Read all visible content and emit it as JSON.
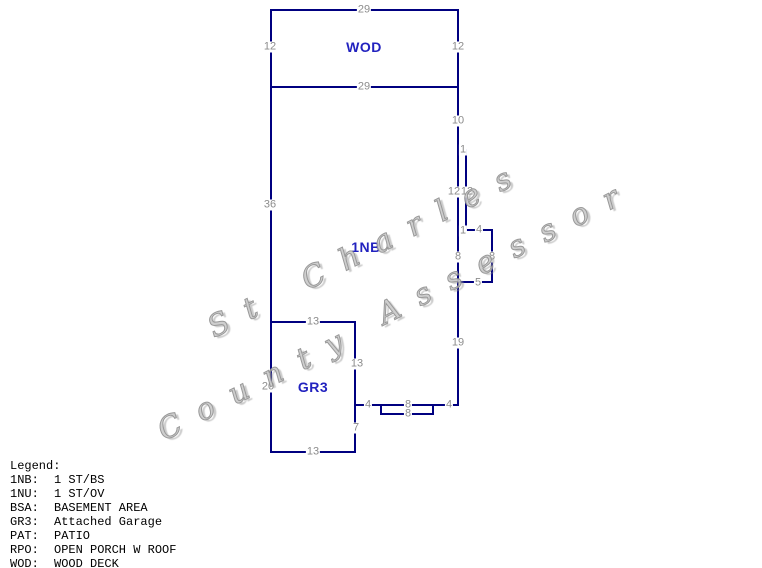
{
  "colors": {
    "line": "#000080",
    "dim_label": "#8c8c8c",
    "area_label": "#2222bf",
    "legend_text": "#000000",
    "watermark": "#9a9a9a",
    "background": "#ffffff"
  },
  "diagram": {
    "lines": [
      {
        "x1": 271,
        "y1": 10,
        "x2": 458,
        "y2": 10
      },
      {
        "x1": 271,
        "y1": 10,
        "x2": 271,
        "y2": 87
      },
      {
        "x1": 458,
        "y1": 10,
        "x2": 458,
        "y2": 87
      },
      {
        "x1": 271,
        "y1": 87,
        "x2": 458,
        "y2": 87
      },
      {
        "x1": 271,
        "y1": 87,
        "x2": 271,
        "y2": 322
      },
      {
        "x1": 271,
        "y1": 322,
        "x2": 271,
        "y2": 452
      },
      {
        "x1": 271,
        "y1": 322,
        "x2": 355,
        "y2": 322
      },
      {
        "x1": 355,
        "y1": 322,
        "x2": 355,
        "y2": 452
      },
      {
        "x1": 271,
        "y1": 452,
        "x2": 355,
        "y2": 452
      },
      {
        "x1": 458,
        "y1": 87,
        "x2": 458,
        "y2": 230
      },
      {
        "x1": 458,
        "y1": 150,
        "x2": 466,
        "y2": 150
      },
      {
        "x1": 466,
        "y1": 150,
        "x2": 466,
        "y2": 230
      },
      {
        "x1": 458,
        "y1": 230,
        "x2": 492,
        "y2": 230
      },
      {
        "x1": 492,
        "y1": 230,
        "x2": 492,
        "y2": 282
      },
      {
        "x1": 458,
        "y1": 230,
        "x2": 458,
        "y2": 282
      },
      {
        "x1": 458,
        "y1": 282,
        "x2": 492,
        "y2": 282
      },
      {
        "x1": 458,
        "y1": 282,
        "x2": 458,
        "y2": 405
      },
      {
        "x1": 355,
        "y1": 405,
        "x2": 458,
        "y2": 405
      },
      {
        "x1": 381,
        "y1": 405,
        "x2": 381,
        "y2": 414
      },
      {
        "x1": 433,
        "y1": 405,
        "x2": 433,
        "y2": 414
      },
      {
        "x1": 381,
        "y1": 414,
        "x2": 433,
        "y2": 414
      }
    ],
    "dim_labels": [
      {
        "text": "29",
        "x": 364,
        "y": 10
      },
      {
        "text": "12",
        "x": 270,
        "y": 47
      },
      {
        "text": "12",
        "x": 458,
        "y": 47
      },
      {
        "text": "29",
        "x": 364,
        "y": 87
      },
      {
        "text": "10",
        "x": 458,
        "y": 121
      },
      {
        "text": "1",
        "x": 463,
        "y": 150
      },
      {
        "text": "12",
        "x": 454,
        "y": 192
      },
      {
        "text": "12",
        "x": 467,
        "y": 192
      },
      {
        "text": "1",
        "x": 463,
        "y": 231
      },
      {
        "text": "4",
        "x": 479,
        "y": 230
      },
      {
        "text": "8",
        "x": 458,
        "y": 257
      },
      {
        "text": "8",
        "x": 492,
        "y": 257
      },
      {
        "text": "5",
        "x": 478,
        "y": 283
      },
      {
        "text": "19",
        "x": 458,
        "y": 343
      },
      {
        "text": "36",
        "x": 270,
        "y": 205
      },
      {
        "text": "13",
        "x": 313,
        "y": 322
      },
      {
        "text": "13",
        "x": 357,
        "y": 364
      },
      {
        "text": "20",
        "x": 268,
        "y": 387
      },
      {
        "text": "7",
        "x": 356,
        "y": 428
      },
      {
        "text": "13",
        "x": 313,
        "y": 452
      },
      {
        "text": "4",
        "x": 368,
        "y": 405
      },
      {
        "text": "8",
        "x": 408,
        "y": 405
      },
      {
        "text": "8",
        "x": 408,
        "y": 414
      },
      {
        "text": "4",
        "x": 449,
        "y": 405
      }
    ],
    "area_labels": [
      {
        "text": "WOD",
        "x": 364,
        "y": 47
      },
      {
        "text": "1NB",
        "x": 366,
        "y": 247
      },
      {
        "text": "GR3",
        "x": 313,
        "y": 387
      }
    ]
  },
  "watermark": {
    "parts": [
      {
        "text": "St Charles",
        "x": 210,
        "y": 315,
        "angle": -27
      },
      {
        "text": "County",
        "x": 160,
        "y": 418,
        "angle": -27
      },
      {
        "text": "Assessor",
        "x": 380,
        "y": 302,
        "angle": -27
      }
    ]
  },
  "legend": {
    "title": "Legend:",
    "entries": [
      {
        "code": "1NB:",
        "desc": "1 ST/BS"
      },
      {
        "code": "1NU:",
        "desc": "1 ST/OV"
      },
      {
        "code": "BSA:",
        "desc": "BASEMENT AREA"
      },
      {
        "code": "GR3:",
        "desc": "Attached Garage"
      },
      {
        "code": "PAT:",
        "desc": "PATIO"
      },
      {
        "code": "RPO:",
        "desc": "OPEN PORCH W ROOF"
      },
      {
        "code": "WOD:",
        "desc": "WOOD DECK"
      }
    ]
  }
}
